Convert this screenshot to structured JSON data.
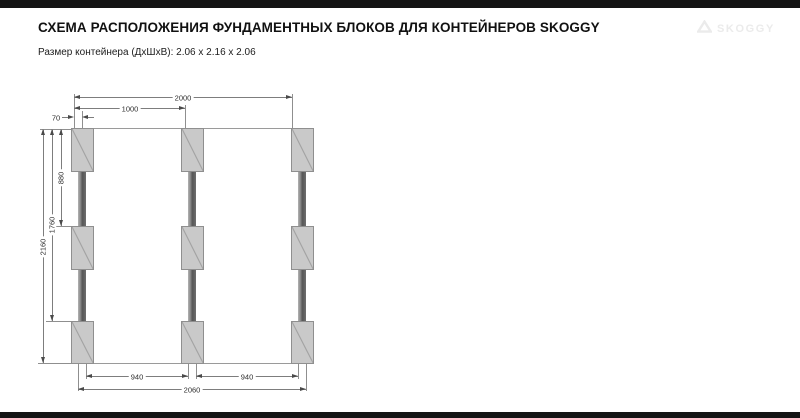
{
  "header": {
    "title": "СХЕМА РАСПОЛОЖЕНИЯ ФУНДАМЕНТНЫХ БЛОКОВ ДЛЯ КОНТЕЙНЕРОВ SKOGGY",
    "subtitle": "Размер контейнера (ДхШхВ): 2.06 x 2.16 x 2.06",
    "logo_text": "SKOGGY"
  },
  "diagram": {
    "dimensions": {
      "top_span": "2000",
      "top_half": "1000",
      "edge_offset": "70",
      "left_row_spacing": "880",
      "left_double_spacing": "1760",
      "left_total": "2160",
      "bottom_gap_left": "940",
      "bottom_gap_right": "940",
      "bottom_total": "2060"
    },
    "colors": {
      "block_fill": "#c9c9c9",
      "beam": "#5e5e5e",
      "dim_line": "#7d7d7d",
      "bar": "#141414",
      "logo": "#ebebeb"
    }
  }
}
